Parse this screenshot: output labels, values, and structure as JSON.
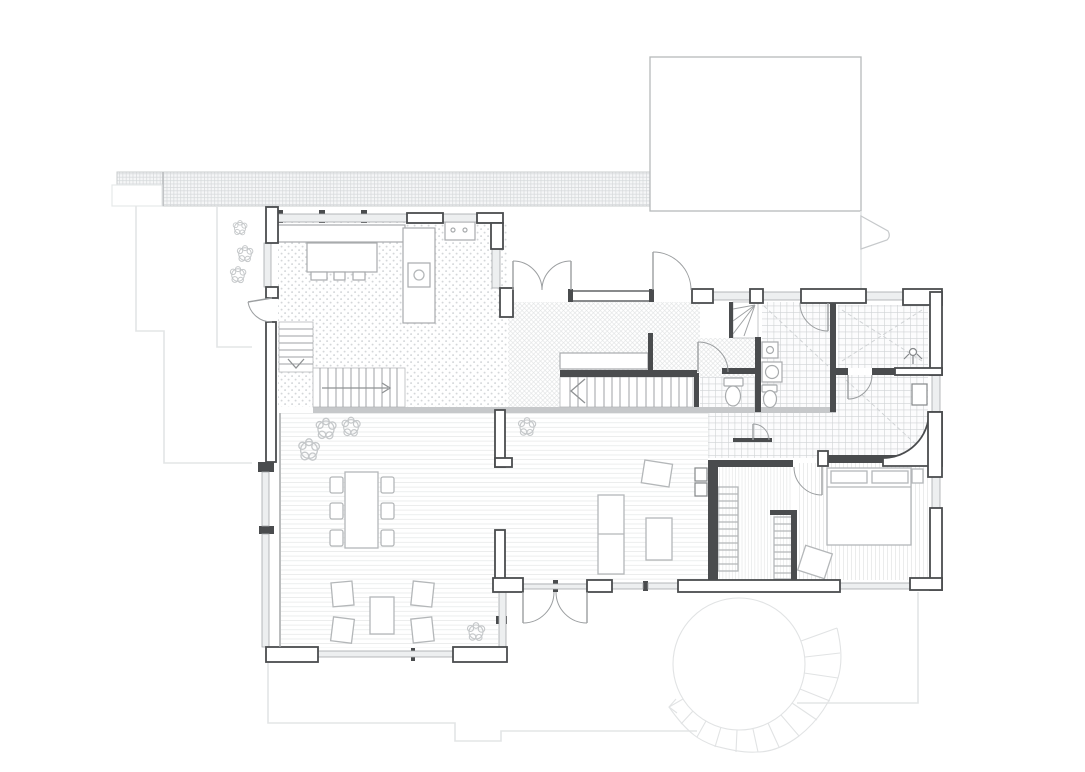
{
  "document": {
    "title": "Architectural floor plan — ground floor",
    "description": "Black-and-white CAD drawing of a house ground floor with kitchen, entry hall, stairs, bathrooms, bedroom, living-dining room, terrace, outbuilding and exterior spiral stair. No text labels are rendered in the drawing.",
    "visible_text": []
  },
  "palette": {
    "wall": "#4a4c4e",
    "glassFill": "#edeff0",
    "glassStroke": "#a5a8ab",
    "furn": "#b4b7b9",
    "fix": "#a8abad",
    "doorArc": "#9b9ea0",
    "site": "#e3e5e6",
    "spiral": "#e1e3e4",
    "stairLine": "#9fa2a4",
    "arrow": "#8f9294",
    "plant": "#c5c8ca",
    "tileLine": "#d0d3d5",
    "grayband": "#c6c8ca",
    "bandLine": "#d6d9db",
    "hatchDot": "#d4d7d9",
    "floorLine": "#ebecec",
    "background": "#ffffff"
  },
  "legend": {
    "site_features": [
      "gravel-strip",
      "site-boundary-lines",
      "outbuilding-outline",
      "gate-symbol",
      "terrace-outline",
      "exterior-spiral-stair"
    ],
    "rooms": [
      "kitchen",
      "entry-hall",
      "wc",
      "laundry-bathroom",
      "shower-room",
      "corridor",
      "walk-in-closet",
      "bedroom",
      "living-dining-room",
      "family-area"
    ],
    "fixtures": [
      "kitchen-island",
      "kitchen-counter",
      "sink",
      "tall-cabinet",
      "staircase-up",
      "staircase-down",
      "basement-winder-stair",
      "sideboard",
      "toilet",
      "washing-machine",
      "shower-head",
      "electrical-panel",
      "dining-table",
      "dining-chairs",
      "armchairs",
      "coffee-table",
      "sofa",
      "chaise",
      "tv-shelf",
      "bed",
      "pillows",
      "nightstand",
      "pouf",
      "wardrobe-shelves",
      "plants"
    ]
  }
}
